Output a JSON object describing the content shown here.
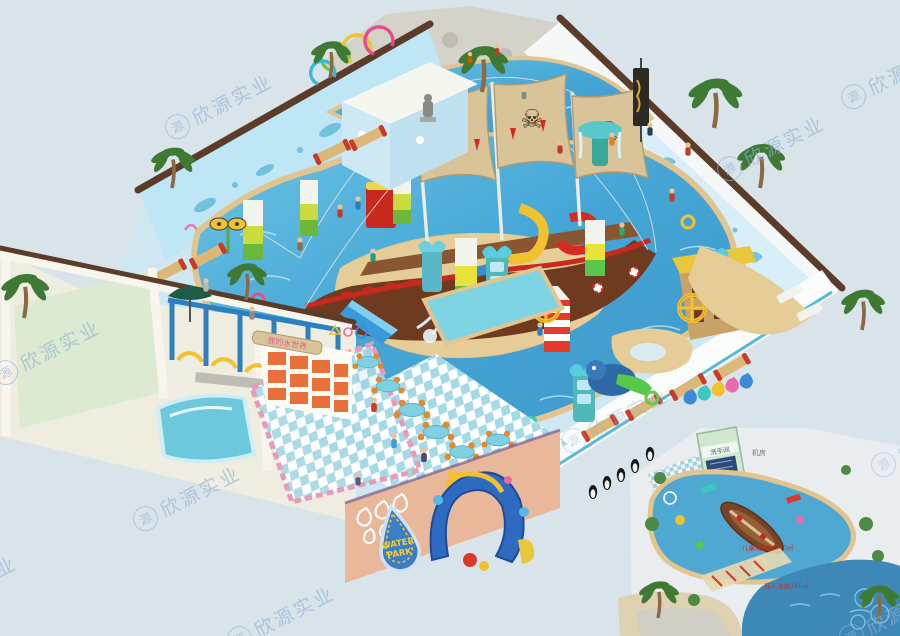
{
  "image": {
    "type": "3d-architectural-render",
    "subject": "indoor kids water park with pirate ship theme, isometric overview with top-down floor plan inset"
  },
  "palette": {
    "background": "#d9e3ea",
    "deck": "#cfe7f0",
    "pool_water": "#45a6d6",
    "pool_water_light": "#7fd0e6",
    "sand": "#e6cd98",
    "sand_edge": "#e2c48e",
    "ship_hull": "#6e3a20",
    "ship_deck": "#8a5632",
    "ship_red": "#c8281e",
    "sail": "#d9c49a",
    "wall_trim": "#5a3c28",
    "mural_wall": "#bfe6f4",
    "rock_wall": "#d3d3ca",
    "annex_wall": "#f3f0e6",
    "annex_floor": "#dcead2",
    "salmon_wall": "#e9b89b",
    "shower_blue": "#2e7fc0",
    "shower_arc_yellow": "#f2c12e",
    "locker_orange": "#e8703a",
    "table_top": "#7fd0e0",
    "chair_orange": "#e08a2e",
    "tower_teal": "#4fb8b8",
    "plan_pool": "#4fa8d2",
    "plan_adult_pool": "#3e88b8"
  },
  "watermark": {
    "logo_char": "源",
    "company": "欣源实业"
  },
  "signs": {
    "water_park_line1": "WATER",
    "water_park_line2": "PARK",
    "locker_wall_sign": "我的水世界",
    "sail_emblem": "☠"
  },
  "inset_plan": {
    "restroom_label": "洗手间",
    "machine_room_label": "机房",
    "kids_pool_label": "儿童戏水池120㎡",
    "adult_pool_label": "成人泳池165㎡"
  }
}
